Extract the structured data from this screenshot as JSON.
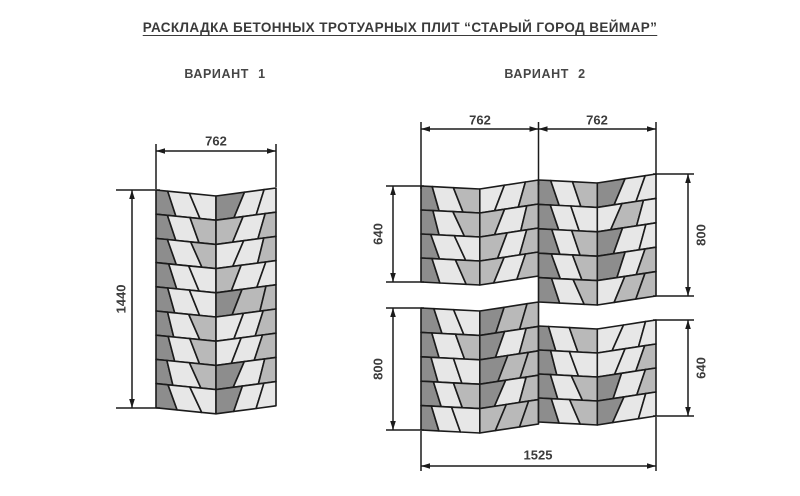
{
  "title": "РАСКЛАДКА БЕТОННЫХ ТРОТУАРНЫХ ПЛИТ “СТАРЫЙ ГОРОД ВЕЙМАР”",
  "variants": {
    "v1": {
      "label": "ВАРИАНТ 1",
      "rows": 9,
      "dims": {
        "width": "762",
        "height": "1440"
      }
    },
    "v2": {
      "label": "ВАРИАНТ 2",
      "upper_block": {
        "rows_left": 4,
        "rows_right": 5
      },
      "lower_block": {
        "rows_left": 5,
        "rows_right": 4
      },
      "dims": {
        "width_left": "762",
        "width_right": "762",
        "upper_left_height": "640",
        "upper_right_height": "800",
        "lower_left_height": "800",
        "lower_right_height": "640",
        "total_width": "1525"
      }
    }
  },
  "colors": {
    "tile_dark": "#8d8d8d",
    "tile_medium": "#b9b9b9",
    "tile_light": "#e7e7e7",
    "line": "#1b1b1b",
    "text": "#3c3c3c",
    "background": "#ffffff"
  }
}
